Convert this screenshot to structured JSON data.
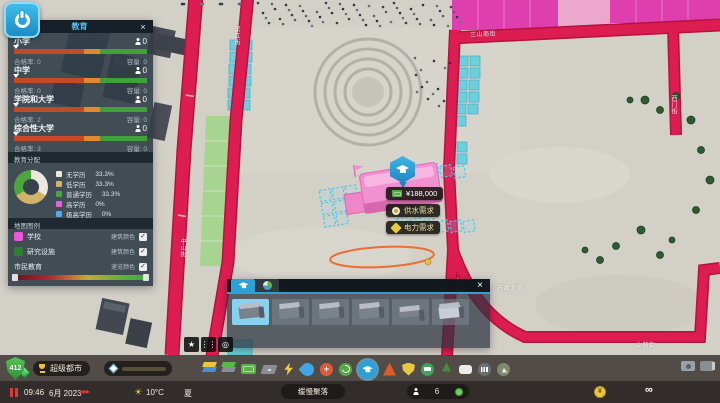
{
  "colors": {
    "accent": "#2da0d8",
    "road": "#dd1d52",
    "zone_magenta": "#df3fae",
    "zone_green": "#a5d48e",
    "zone_cyan": "#6ccfdd"
  },
  "menu_button": {
    "icon": "power-icon"
  },
  "info_panel": {
    "title": "教育",
    "close_label": "×",
    "schools": [
      {
        "name": "小学",
        "count": "0",
        "eligible_label": "合格率:",
        "eligible": "0",
        "capacity_label": "容量:",
        "capacity": "0"
      },
      {
        "name": "中学",
        "count": "0",
        "eligible_label": "合格率:",
        "eligible": "0",
        "capacity_label": "容量:",
        "capacity": "0"
      },
      {
        "name": "学院和大学",
        "count": "0",
        "eligible_label": "合格率:",
        "eligible": "2",
        "capacity_label": "容量:",
        "capacity": "0"
      },
      {
        "name": "综合性大学",
        "count": "0",
        "eligible_label": "合格率:",
        "eligible": "3",
        "capacity_label": "容量:",
        "capacity": "0"
      }
    ],
    "distribution": {
      "header": "教育分配",
      "legend": [
        {
          "label": "无学历",
          "value": "33.3%",
          "color": "#ece8de"
        },
        {
          "label": "低学历",
          "value": "33.3%",
          "color": "#d2b36a"
        },
        {
          "label": "普通学历",
          "value": "33.3%",
          "color": "#4ba63e"
        },
        {
          "label": "高学历",
          "value": "0%",
          "color": "#e55fd5"
        },
        {
          "label": "极高学历",
          "value": "0%",
          "color": "#55a9e8"
        }
      ]
    },
    "map_legend": {
      "header": "地图图例",
      "rows": [
        {
          "label": "学校",
          "swatch": "#ea57d8",
          "toggle": "建筑颜色",
          "check": "✓"
        },
        {
          "label": "研究设施",
          "swatch": "#2f7d34",
          "toggle": "建筑颜色",
          "check": "✓"
        }
      ],
      "gradient_row": {
        "label": "市民教育",
        "toggle": "速览颜色",
        "check": "✓"
      }
    }
  },
  "placement": {
    "cost": "¥188,000",
    "warning1": "供水需求",
    "warning2": "电力需求"
  },
  "asset_panel": {
    "close_label": "×"
  },
  "snap_buttons": {
    "star": "★",
    "snap": "⋮⋮",
    "globe": "◎"
  },
  "statusbar": {
    "level": "412",
    "milestone": "超级都市",
    "time": "09:46",
    "date": "6月 2023",
    "speed": "▸▸▸",
    "sun": "☀",
    "temperature": "10°C",
    "season": "夏",
    "city_name": "缓慢聚落",
    "population": "6",
    "money": "∞"
  },
  "streets": [
    {
      "label": "滨江街"
    },
    {
      "label": "三山南街"
    },
    {
      "label": "西门街"
    },
    {
      "label": "石湖大道"
    },
    {
      "label": "山前街"
    },
    {
      "label": "中山街"
    }
  ]
}
